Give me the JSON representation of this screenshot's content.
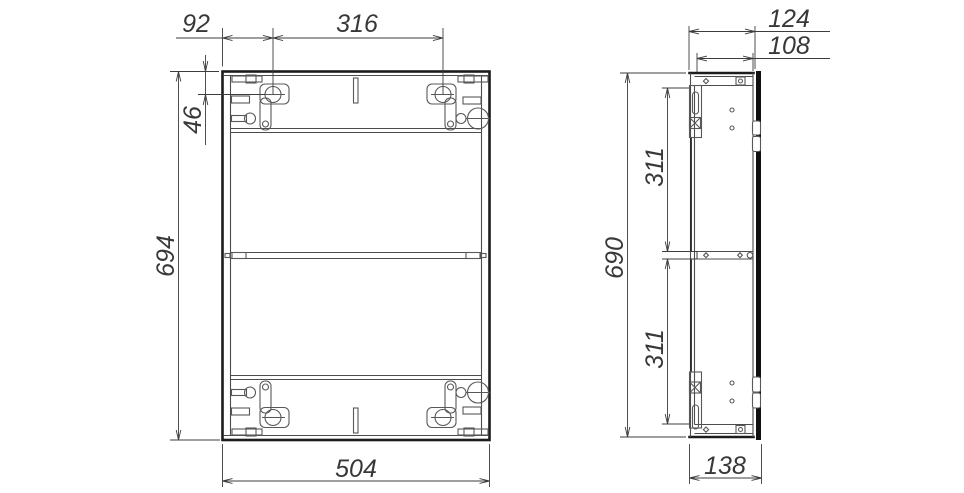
{
  "drawing": {
    "background": "#ffffff",
    "line_color": "#1c1c1c",
    "dim_color": "#3d3d3d"
  },
  "dims": {
    "front": {
      "hanger_offset": "92",
      "hanger_spacing": "316",
      "hanger_drop": "46",
      "height": "694",
      "width": "504"
    },
    "side": {
      "depth_body": "124",
      "depth_inner": "108",
      "height": "690",
      "shelf_span_upper": "311",
      "shelf_span_lower": "311",
      "depth_total": "138"
    }
  }
}
